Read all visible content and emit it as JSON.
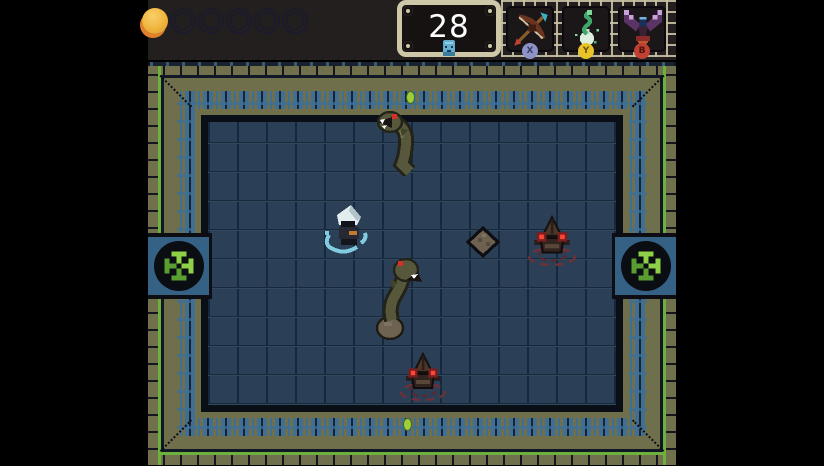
{
  "hud": {
    "health": {
      "orbs_total": 6,
      "orbs_filled": 1
    },
    "counter": {
      "value": "28",
      "icon": "blue-mask-icon"
    },
    "item_slots": [
      {
        "name": "bow",
        "button_label": "X",
        "button_color": "#8d92c7"
      },
      {
        "name": "snake-elixir",
        "button_label": "Y",
        "button_color": "#e8c428"
      },
      {
        "name": "bird-totem",
        "button_label": "B",
        "button_color": "#c04032"
      }
    ]
  },
  "room": {
    "doors": [
      {
        "side": "west",
        "state": "sealed",
        "emblem": "green-pinwheel"
      },
      {
        "side": "east",
        "state": "sealed",
        "emblem": "green-pinwheel"
      }
    ],
    "markers": [
      {
        "side": "north",
        "color": "#9ccf3a"
      },
      {
        "side": "south",
        "color": "#9ccf3a"
      }
    ],
    "entities": [
      {
        "name": "player",
        "state": "in-water-ripple"
      },
      {
        "name": "eel-enemy-north",
        "state": "emerged"
      },
      {
        "name": "eel-enemy-center",
        "state": "emerged"
      },
      {
        "name": "sentinel-enemy-east",
        "state": "submerged-ripples"
      },
      {
        "name": "sentinel-enemy-south",
        "state": "submerged-ripples"
      },
      {
        "name": "rock",
        "state": "static"
      }
    ]
  },
  "colors": {
    "hud_background": "#241f1f",
    "health_filled": "#f0b43c",
    "health_cup": "#e2812a",
    "counter_frame": "#cfc8a8",
    "counter_text": "#ffffff",
    "border_brick": "#70704c",
    "border_green_accent": "#6cb13c",
    "meander_band": "#3f6f94",
    "floor": "#2b4056",
    "door_emblem_green": "#8ed048",
    "enemy_eye_red": "#ff4538",
    "ripple_blue": "#82cce2",
    "ripple_red": "#6e3038"
  }
}
